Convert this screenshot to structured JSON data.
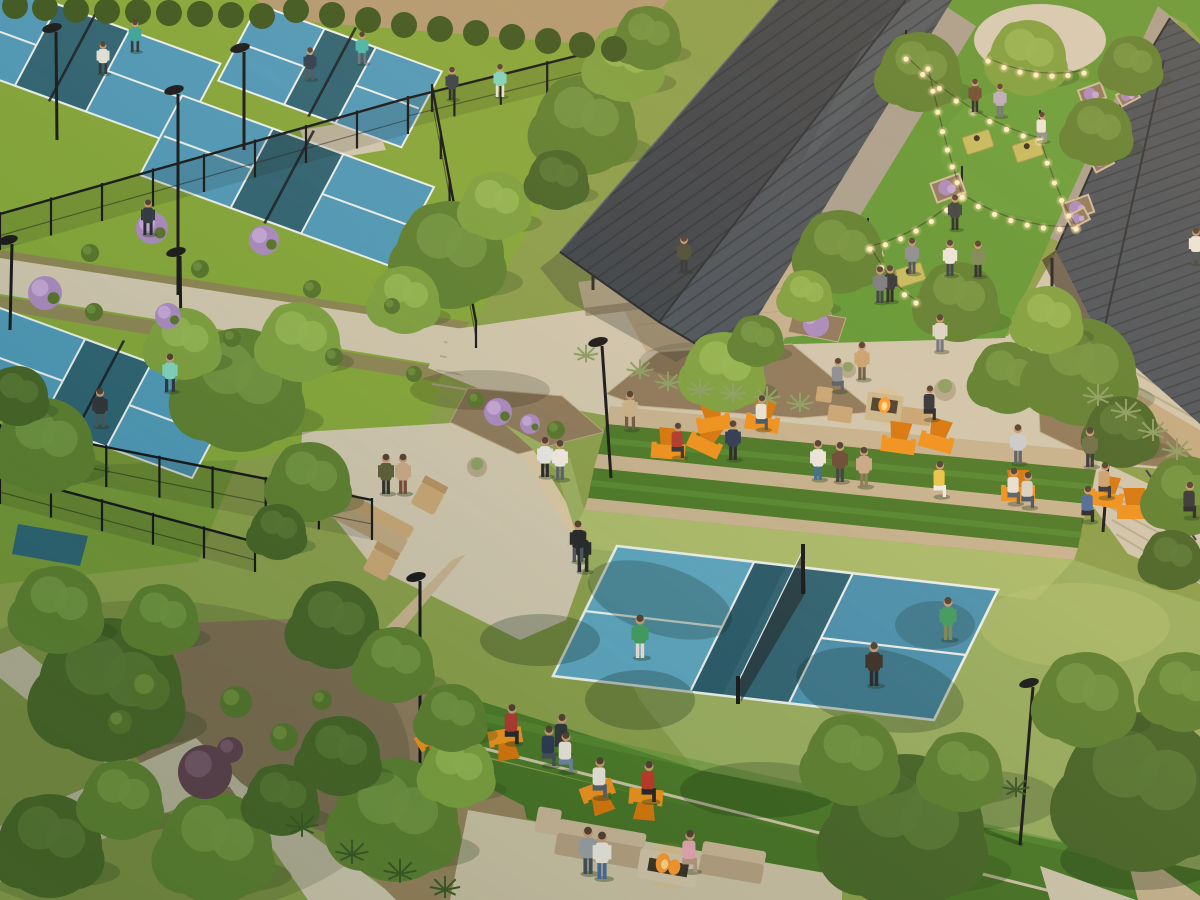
{
  "scene_label": "aerial-architectural-rendering-pickleball-club",
  "palette": {
    "base": "#8aa04e",
    "apron_tl": "#84a83c",
    "apron_main": "#9ab063",
    "apron_sun": "#bcc979",
    "court_blue": "#4e9abc",
    "court_blue_lt": "#5aa6c4",
    "court_blue_dk": "#4a93b4",
    "kitchen": "#2d6476",
    "kitchen_dk": "#24556a",
    "line": "#edf3f1",
    "lawn": "#609a38",
    "turf": "#4a7a2a",
    "turf_lt": "#5c9338",
    "turf_dk": "#477428",
    "path": "#d0c8b2",
    "path_dk": "#b5ab92",
    "paver": "#a8a193",
    "dirt": "#b29b74",
    "gravel": "#8f7c60",
    "soil": "#8d7a5e",
    "wall": "#c6b492",
    "wall_dk": "#a7977a",
    "wall_lt": "#d8c8a6",
    "stone_bld": "#c3ac85",
    "floor": "#c3b192",
    "roof_dark": "#3c444d",
    "roof_mid": "#49535e",
    "roof_lt": "#5b6771",
    "rib": "#272d34",
    "wood": "#c8a878",
    "wood_dk": "#9a7a4e",
    "sofa": "#c9b79a",
    "sofa_dk": "#b6a284",
    "orange": "#f0931f",
    "orange_dk": "#d8780f",
    "fire": "#ff9b30",
    "fire_core": "#ffd98e",
    "tree_light": "#7da242",
    "tree_light_hi": "#93b755",
    "tree_mid": "#5d8133",
    "tree_mid_hi": "#719644",
    "tree_dark": "#47662a",
    "tree_dark_hi": "#587936",
    "hedge": "#3c5822",
    "purple": "#a98bc4",
    "purple_hi": "#c3a7d9",
    "wine": "#5c4050",
    "wine_hi": "#74566a",
    "shrub": "#55752f",
    "shrub_hi": "#6a8c3c",
    "agave": "#8aa065",
    "spike": "#3a5a28",
    "metal": "#15181b",
    "skin": "#c99b78",
    "hair": "#43362c",
    "bulb": "#fff3cf",
    "bulb_glow": "#ffd98e",
    "shade": "#1f4032"
  },
  "objects": {
    "court_axes": {
      "u_deg": 20,
      "v_deg": 118
    },
    "courts": [
      {
        "cx": 72,
        "cy": 58,
        "w": 270,
        "h": 92
      },
      {
        "cx": 330,
        "cy": 76,
        "w": 195,
        "h": 86
      },
      {
        "cx": 287,
        "cy": 181,
        "w": 268,
        "h": 90
      },
      {
        "cx": 96,
        "cy": 393,
        "w": 252,
        "h": 95
      }
    ],
    "trees": [
      [
        240,
        390,
        62,
        "m"
      ],
      [
        300,
        342,
        40,
        "l"
      ],
      [
        184,
        344,
        36,
        "l"
      ],
      [
        45,
        446,
        48,
        "m"
      ],
      [
        18,
        396,
        30,
        "d"
      ],
      [
        450,
        255,
        54,
        "m"
      ],
      [
        405,
        300,
        34,
        "l"
      ],
      [
        496,
        206,
        34,
        "l"
      ],
      [
        585,
        125,
        50,
        "m"
      ],
      [
        625,
        64,
        38,
        "l"
      ],
      [
        558,
        180,
        30,
        "d"
      ],
      [
        648,
        38,
        32,
        "m"
      ],
      [
        840,
        252,
        42,
        "m"
      ],
      [
        806,
        296,
        26,
        "l"
      ],
      [
        724,
        372,
        40,
        "l"
      ],
      [
        757,
        341,
        26,
        "m"
      ],
      [
        1008,
        378,
        36,
        "m"
      ],
      [
        1082,
        372,
        54,
        "m"
      ],
      [
        1048,
        320,
        34,
        "l"
      ],
      [
        1122,
        432,
        36,
        "d"
      ],
      [
        1186,
        496,
        40,
        "m"
      ],
      [
        1172,
        560,
        30,
        "d"
      ],
      [
        920,
        72,
        40,
        "m"
      ],
      [
        1028,
        58,
        38,
        "l"
      ],
      [
        1098,
        132,
        34,
        "m"
      ],
      [
        958,
        302,
        40,
        "m"
      ],
      [
        1132,
        66,
        30,
        "m"
      ],
      [
        110,
        690,
        72,
        "d"
      ],
      [
        58,
        610,
        44,
        "m"
      ],
      [
        162,
        620,
        36,
        "m"
      ],
      [
        50,
        846,
        52,
        "d"
      ],
      [
        122,
        800,
        40,
        "m"
      ],
      [
        216,
        848,
        56,
        "m"
      ],
      [
        282,
        800,
        36,
        "d"
      ],
      [
        396,
        820,
        62,
        "m"
      ],
      [
        340,
        756,
        40,
        "d"
      ],
      [
        458,
        772,
        36,
        "l"
      ],
      [
        310,
        482,
        40,
        "m"
      ],
      [
        278,
        532,
        28,
        "d"
      ],
      [
        335,
        625,
        44,
        "d"
      ],
      [
        395,
        665,
        38,
        "m"
      ],
      [
        906,
        832,
        78,
        "d"
      ],
      [
        852,
        760,
        46,
        "m"
      ],
      [
        962,
        772,
        40,
        "m"
      ],
      [
        1142,
        792,
        80,
        "d"
      ],
      [
        1086,
        700,
        48,
        "m"
      ],
      [
        1184,
        692,
        40,
        "m"
      ],
      [
        452,
        718,
        34,
        "m"
      ]
    ],
    "hedges": [
      [
        15,
        6
      ],
      [
        45,
        8
      ],
      [
        76,
        10
      ],
      [
        107,
        11
      ],
      [
        138,
        12
      ],
      [
        169,
        13
      ],
      [
        200,
        14
      ],
      [
        231,
        15
      ],
      [
        262,
        16
      ],
      [
        296,
        10
      ],
      [
        332,
        15
      ],
      [
        368,
        20
      ],
      [
        404,
        25
      ],
      [
        440,
        29
      ],
      [
        476,
        33
      ],
      [
        512,
        37
      ],
      [
        548,
        41
      ],
      [
        582,
        45
      ],
      [
        614,
        49
      ]
    ],
    "shrubs": [
      [
        152,
        228,
        16,
        "purple"
      ],
      [
        264,
        240,
        15,
        "purple"
      ],
      [
        45,
        293,
        17,
        "purple"
      ],
      [
        168,
        316,
        13,
        "purple"
      ],
      [
        498,
        412,
        14,
        "purple"
      ],
      [
        530,
        424,
        10,
        "purple"
      ],
      [
        90,
        253,
        9,
        "green"
      ],
      [
        200,
        269,
        9,
        "green"
      ],
      [
        312,
        289,
        9,
        "green"
      ],
      [
        392,
        306,
        8,
        "green"
      ],
      [
        94,
        312,
        9,
        "green"
      ],
      [
        232,
        338,
        9,
        "green"
      ],
      [
        334,
        357,
        9,
        "green"
      ],
      [
        414,
        374,
        8,
        "green"
      ],
      [
        150,
        690,
        20,
        "green"
      ],
      [
        236,
        702,
        16,
        "green"
      ],
      [
        284,
        737,
        14,
        "green"
      ],
      [
        120,
        722,
        12,
        "green"
      ],
      [
        322,
        700,
        10,
        "green"
      ],
      [
        476,
        400,
        8,
        "green"
      ],
      [
        556,
        430,
        9,
        "green"
      ],
      [
        205,
        772,
        27,
        "wine"
      ],
      [
        230,
        750,
        13,
        "wine"
      ],
      [
        640,
        372,
        9,
        "agave"
      ],
      [
        668,
        384,
        9,
        "agave"
      ],
      [
        700,
        391,
        9,
        "agave"
      ],
      [
        733,
        395,
        9,
        "agave"
      ],
      [
        767,
        399,
        9,
        "agave"
      ],
      [
        800,
        405,
        9,
        "agave"
      ],
      [
        586,
        356,
        8,
        "agave"
      ],
      [
        1098,
        398,
        10,
        "agave"
      ],
      [
        1126,
        413,
        10,
        "agave"
      ],
      [
        1153,
        433,
        10,
        "agave"
      ],
      [
        1177,
        452,
        10,
        "agave"
      ],
      [
        302,
        828,
        11,
        "spike"
      ],
      [
        352,
        855,
        11,
        "spike"
      ],
      [
        400,
        874,
        11,
        "spike"
      ],
      [
        445,
        890,
        10,
        "spike"
      ],
      [
        1016,
        790,
        9,
        "spike"
      ]
    ],
    "planters": [
      [
        940,
        82,
        30,
        20,
        -20
      ],
      [
        1092,
        94,
        24,
        16,
        -20
      ],
      [
        948,
        188,
        30,
        20,
        -20
      ],
      [
        1078,
        208,
        28,
        18,
        -20
      ],
      [
        868,
        252,
        26,
        17,
        -20
      ],
      [
        1128,
        96,
        20,
        13,
        -28
      ],
      [
        1102,
        162,
        20,
        13,
        -28
      ],
      [
        1078,
        218,
        20,
        13,
        -28
      ]
    ],
    "cornhole": [
      [
        978,
        142,
        -18
      ],
      [
        1028,
        150,
        -18
      ],
      [
        910,
        275,
        -18
      ],
      [
        962,
        282,
        -18
      ]
    ],
    "chairs_orange": [
      [
        668,
        452,
        5
      ],
      [
        704,
        446,
        25
      ],
      [
        714,
        424,
        -10
      ],
      [
        762,
        424,
        10
      ],
      [
        898,
        446,
        8
      ],
      [
        936,
        443,
        15
      ],
      [
        1018,
        494,
        0
      ],
      [
        1106,
        500,
        10
      ],
      [
        1134,
        512,
        0
      ],
      [
        1188,
        518,
        -8
      ],
      [
        505,
        736,
        170
      ],
      [
        432,
        736,
        150
      ],
      [
        597,
        790,
        160
      ],
      [
        646,
        796,
        185
      ]
    ],
    "lamps": [
      [
        52,
        28,
        57,
        140
      ],
      [
        174,
        90,
        178,
        295
      ],
      [
        176,
        252,
        182,
        420
      ],
      [
        240,
        48,
        244,
        150
      ],
      [
        8,
        240,
        10,
        330
      ],
      [
        416,
        577,
        420,
        775
      ],
      [
        598,
        342,
        611,
        478
      ],
      [
        1029,
        683,
        1020,
        845
      ],
      [
        1107,
        419,
        1103,
        532
      ]
    ],
    "strand_poles": [
      [
        906,
        30,
        58
      ],
      [
        928,
        40,
        68
      ],
      [
        962,
        166,
        196
      ],
      [
        1076,
        198,
        228
      ],
      [
        868,
        218,
        248
      ],
      [
        1040,
        110,
        140
      ]
    ],
    "light_strands": [
      [
        906,
        56,
        1040,
        138,
        12,
        9
      ],
      [
        988,
        58,
        1084,
        70,
        8,
        7
      ],
      [
        928,
        66,
        962,
        194,
        8,
        8
      ],
      [
        962,
        194,
        1076,
        226,
        10,
        8
      ],
      [
        870,
        246,
        962,
        194,
        8,
        7
      ],
      [
        870,
        246,
        916,
        300,
        7,
        5
      ],
      [
        1040,
        138,
        1076,
        226,
        7,
        6
      ]
    ],
    "fences": [
      [
        0,
        214,
        408,
        98,
        8,
        36,
        1
      ],
      [
        408,
        98,
        640,
        40,
        5,
        30,
        1
      ],
      [
        432,
        86,
        476,
        322,
        5,
        26,
        0
      ],
      [
        0,
        426,
        372,
        500,
        7,
        40,
        1
      ],
      [
        0,
        474,
        255,
        542,
        5,
        30,
        1
      ]
    ],
    "people": [
      [
        103,
        74,
        "#e3e3de",
        "#2f3338",
        "w"
      ],
      [
        135,
        52,
        "#3aa69e",
        "#30343a",
        "w"
      ],
      [
        310,
        80,
        "#2c3e50",
        "#4a5560",
        "w"
      ],
      [
        362,
        64,
        "#48b8ae",
        "#6b7280",
        "w"
      ],
      [
        500,
        97,
        "#7fd6c2",
        "#e8e4da",
        "w"
      ],
      [
        452,
        100,
        "#384048",
        "#23262b",
        "s"
      ],
      [
        100,
        427,
        "#30343a",
        "#4a5560",
        "w"
      ],
      [
        170,
        392,
        "#7fd6c2",
        "#30343a",
        "w"
      ],
      [
        148,
        235,
        "#2e3744",
        "#1f2630",
        "w"
      ],
      [
        386,
        494,
        "#5a5f3a",
        "#2b2f25",
        "s"
      ],
      [
        403,
        494,
        "#c9a98a",
        "#7a4a3a",
        "s"
      ],
      [
        545,
        477,
        "#e8e8e8",
        "#23262b",
        "s"
      ],
      [
        560,
        480,
        "#f0ede6",
        "#55606b",
        "s"
      ],
      [
        583,
        572,
        "#23262b",
        "#23262b",
        "w"
      ],
      [
        630,
        430,
        "#c9b28a",
        "#6b5a44",
        "w"
      ],
      [
        578,
        562,
        "#23262b",
        "#4a5560",
        "w"
      ],
      [
        640,
        658,
        "#3f9e63",
        "#e8e4da",
        "s"
      ],
      [
        948,
        640,
        "#3f9e63",
        "#7a8a5a",
        "s"
      ],
      [
        874,
        686,
        "#3a2f2c",
        "#23262b",
        "s"
      ],
      [
        562,
        754,
        "#30343a",
        "#30343a",
        "t"
      ],
      [
        678,
        458,
        "#b03a30",
        "#30343a",
        "t"
      ],
      [
        762,
        430,
        "#e8e4da",
        "#44556b",
        "t"
      ],
      [
        733,
        460,
        "#2b3a55",
        "#23262b",
        "s"
      ],
      [
        940,
        352,
        "#ddd8ce",
        "#6b7280",
        "s"
      ],
      [
        838,
        392,
        "#8a8f96",
        "#55606b",
        "t"
      ],
      [
        862,
        380,
        "#c9a273",
        "#6b5a44",
        "s"
      ],
      [
        930,
        420,
        "#30343a",
        "#23262b",
        "t"
      ],
      [
        818,
        480,
        "#ece8e0",
        "#3a6b9a",
        "s"
      ],
      [
        840,
        482,
        "#6b4a36",
        "#3a3f45",
        "s"
      ],
      [
        864,
        487,
        "#c9a98a",
        "#8a7a5a",
        "s"
      ],
      [
        940,
        497,
        "#e8c84a",
        "#f0ede6",
        "t"
      ],
      [
        1014,
        504,
        "#e8e4da",
        "#55606b",
        "t"
      ],
      [
        1028,
        508,
        "#d8d4ca",
        "#44556b",
        "t"
      ],
      [
        1088,
        522,
        "#4a6b9a",
        "#23262b",
        "t"
      ],
      [
        1105,
        498,
        "#c9a273",
        "#30343a",
        "t"
      ],
      [
        1190,
        518,
        "#30343a",
        "#23262b",
        "t"
      ],
      [
        1018,
        464,
        "#caced4",
        "#55606b",
        "s"
      ],
      [
        1090,
        467,
        "#6b6f4a",
        "#30343a",
        "s"
      ],
      [
        975,
        112,
        "#6b4a36",
        "#23262b",
        "s"
      ],
      [
        1000,
        117,
        "#b9aec4",
        "#6b7280",
        "s"
      ],
      [
        1042,
        142,
        "#ece8e0",
        "#8a8f96",
        "t"
      ],
      [
        955,
        230,
        "#3a3f45",
        "#23262b",
        "s"
      ],
      [
        912,
        274,
        "#8a8f96",
        "#44505b",
        "s"
      ],
      [
        950,
        276,
        "#ece8e0",
        "#333d47",
        "s"
      ],
      [
        978,
        277,
        "#7a8a5a",
        "#23262b",
        "s"
      ],
      [
        890,
        302,
        "#30343a",
        "#23262b",
        "s"
      ],
      [
        880,
        303,
        "#777d84",
        "#333d47",
        "s"
      ],
      [
        1196,
        264,
        "#ece8e0",
        "#44505b",
        "w"
      ],
      [
        684,
        272,
        "#4a4f3a",
        "#30343a",
        "s"
      ],
      [
        512,
        744,
        "#b03a30",
        "#23262b",
        "t"
      ],
      [
        549,
        766,
        "#2b3a55",
        "#44505b",
        "t"
      ],
      [
        566,
        772,
        "#ece8e0",
        "#6b86a8",
        "t"
      ],
      [
        600,
        798,
        "#ece8e0",
        "#55606b",
        "t"
      ],
      [
        649,
        802,
        "#c0392b",
        "#23262b",
        "t"
      ],
      [
        690,
        872,
        "#e8a8b8",
        "#b99883",
        "t"
      ],
      [
        588,
        874,
        "#9aa0a8",
        "#44505b",
        "s"
      ],
      [
        602,
        879,
        "#ece8e0",
        "#4a6b9a",
        "s"
      ]
    ]
  }
}
